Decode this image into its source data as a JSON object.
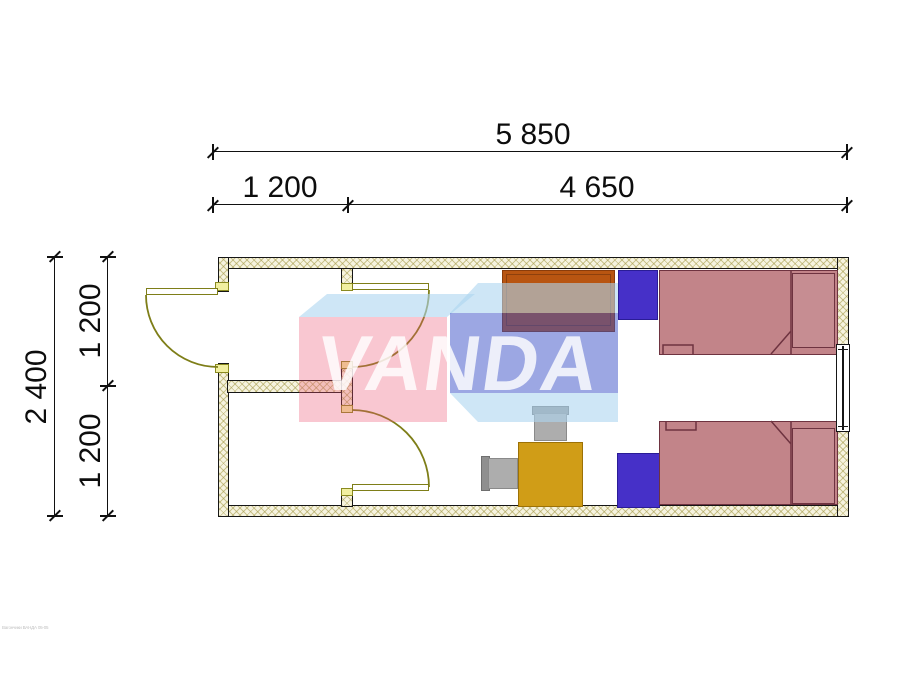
{
  "dimensions": {
    "top_total": "5 850",
    "top_segment_left": "1 200",
    "top_segment_right": "4 650",
    "left_total": "2 400",
    "left_segment_upper": "1 200",
    "left_segment_lower": "1 200"
  },
  "watermark": {
    "brand": "VANDA"
  },
  "footer": {
    "credit": "Вагончики ВАНДА 05-05"
  },
  "plan": {
    "items": [
      "exterior-door",
      "interior-door-upper",
      "interior-door-lower",
      "window",
      "wardrobe",
      "nightstand",
      "single-bed",
      "single-bed",
      "nightstand",
      "dining-table",
      "chair",
      "chair"
    ],
    "colors": {
      "wall_fill": "#f6f3df",
      "wall_hatch": "#cdc68f",
      "door_olive": "#7e7e18",
      "jamb_yellow": "#f1efa0",
      "bed_fill": "#c28489",
      "bed_outline": "#6e3340",
      "nightstand_blue": "#4630c8",
      "wardrobe_orange": "#b85511",
      "table_gold": "#d09d17",
      "chair_gray": "#adadad",
      "watermark_red": "#ef5e78",
      "watermark_blue": "#3a50c8",
      "watermark_lightblue": "#aed6f0"
    }
  }
}
